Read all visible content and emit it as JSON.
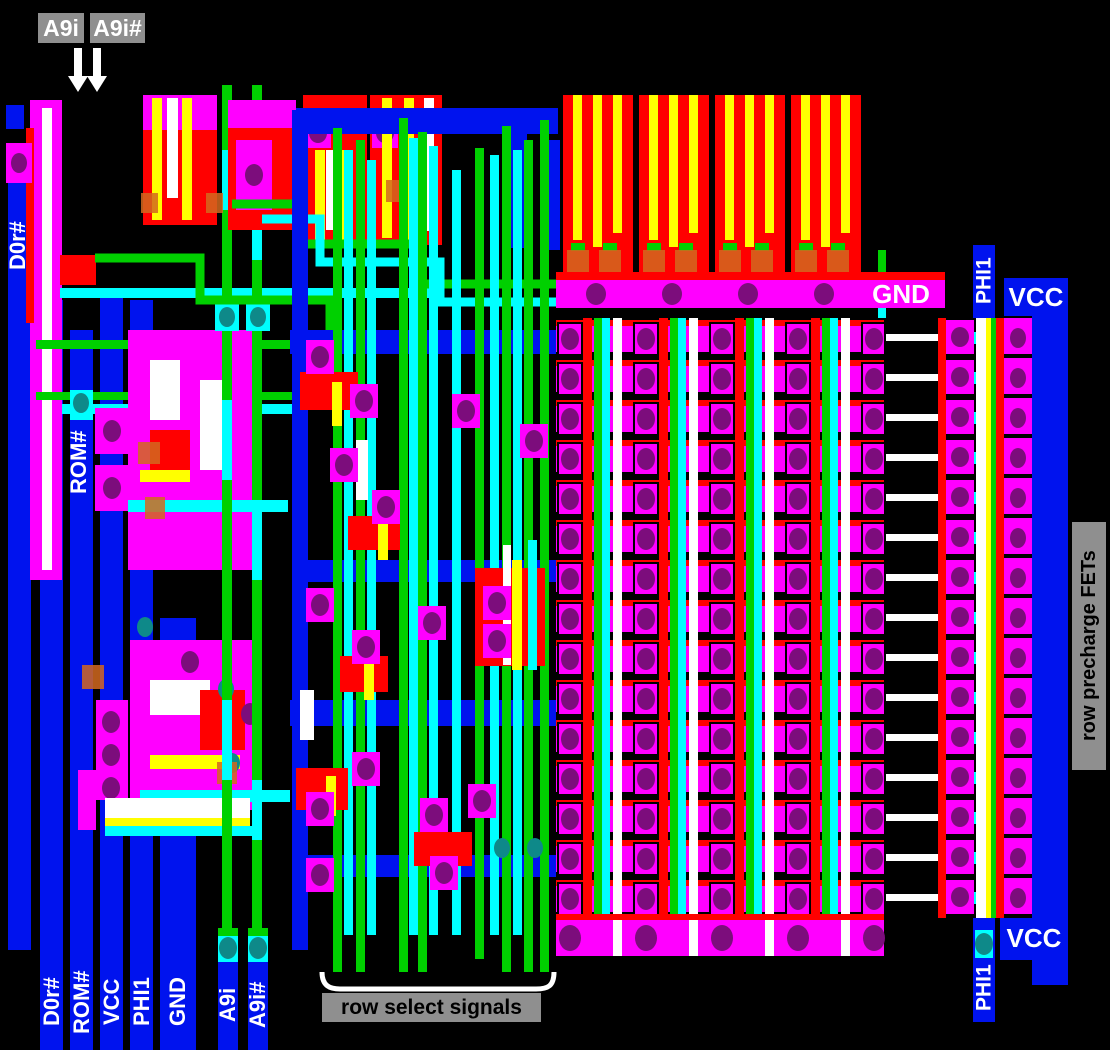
{
  "meta": {
    "description": "Annotated MOS chip die layout: ROM array with row select signals and row precharge FETs",
    "width_px": 1110,
    "height_px": 1050
  },
  "colors": {
    "bg": "#000000",
    "blue": "#0013EE",
    "magenta": "#FF00FF",
    "red": "#FF0000",
    "green": "#00D000",
    "cyan": "#00FFFF",
    "yellow": "#FFFF00",
    "white": "#FFFFFF",
    "purple": "#7C0D7C",
    "teal": "#0E8989",
    "orange": "#D2691E",
    "gray": "#8F8F8F",
    "label_white": "#FFFFFF",
    "label_black": "#000000"
  },
  "callouts": {
    "a9i": "A9i",
    "a9i_b": "A9i#",
    "row_precharge": "row precharge FETs",
    "row_select": "row select signals"
  },
  "rails": {
    "d0r_top": "D0r#",
    "rom_top": "ROM#",
    "gnd_bar": "GND",
    "phi1_top": "PHI1",
    "vcc_top": "VCC",
    "phi1_bottom": "PHI1",
    "vcc_bottom": "VCC"
  },
  "bus_labels": [
    {
      "label": "D0r#"
    },
    {
      "label": "ROM#"
    },
    {
      "label": "VCC"
    },
    {
      "label": "PHI1"
    },
    {
      "label": "GND"
    },
    {
      "label": "A9i"
    },
    {
      "label": "A9i#"
    }
  ],
  "array": {
    "rows": 15,
    "precharge_wires": 15,
    "top_driver_blocks": 4
  }
}
